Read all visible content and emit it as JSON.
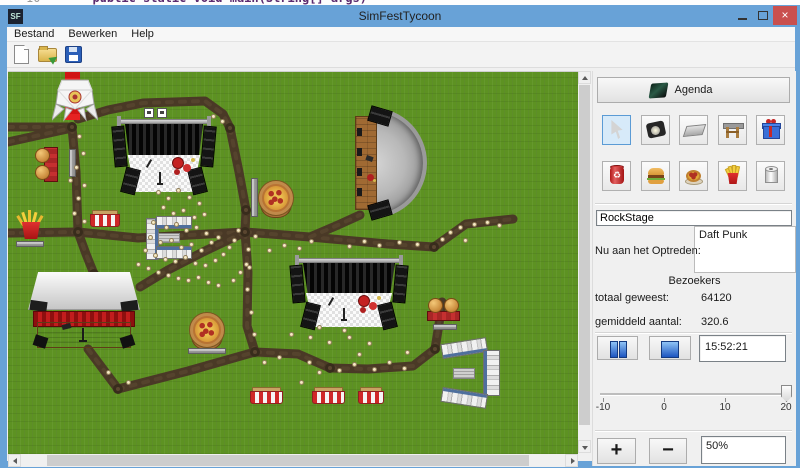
{
  "desktop": {
    "code_line_number": "10",
    "code_fragment": "public static void main(String[] args)"
  },
  "window": {
    "title": "SimFestTycoon",
    "icon_text": "SF",
    "menu": [
      "Bestand",
      "Bewerken",
      "Help"
    ],
    "toolbar_icons": [
      "new-file",
      "open-file",
      "save-file"
    ],
    "controls": {
      "minimize": "",
      "maximize": "",
      "close": "×"
    }
  },
  "panel": {
    "agenda_label": "Agenda",
    "tools": [
      "select-cursor",
      "stage-light",
      "path-tile",
      "stage-truss",
      "gift",
      "trash-can",
      "burger",
      "pizza",
      "fries",
      "toilet-roll"
    ],
    "selected_tool_index": 0,
    "stage_name_value": "RockStage",
    "now_performing_label": "Nu aan het Optreden:",
    "now_performing_value": "Daft Punk",
    "visitors_header": "Bezoekers",
    "total_label": "totaal geweest:",
    "total_value": "64120",
    "average_label": "gemiddeld aantal:",
    "average_value": "320.6",
    "time_value": "15:52:21",
    "slider": {
      "labels": [
        "-10",
        "0",
        "10",
        "20"
      ],
      "value": 20
    },
    "zoom_in_label": "+",
    "zoom_out_label": "−",
    "zoom_value": "50%"
  },
  "map": {
    "structures": [
      {
        "type": "red-carpet",
        "x": 57,
        "y": 0,
        "w": 15,
        "h": 48
      },
      {
        "type": "tent",
        "x": 44,
        "y": 6,
        "w": 46,
        "h": 44
      },
      {
        "type": "stage",
        "x": 105,
        "y": 44,
        "w": 102,
        "h": 78,
        "flags": true
      },
      {
        "type": "amphitheater",
        "x": 347,
        "y": 36,
        "w": 72,
        "h": 110
      },
      {
        "type": "burger-v",
        "x": 27,
        "y": 75,
        "w": 26,
        "h": 35
      },
      {
        "type": "bench-v",
        "x": 61,
        "y": 77,
        "w": 7,
        "h": 28
      },
      {
        "type": "bench-v",
        "x": 243,
        "y": 106,
        "w": 7,
        "h": 39
      },
      {
        "type": "pizza",
        "x": 250,
        "y": 108,
        "w": 36,
        "h": 40
      },
      {
        "type": "fries",
        "x": 5,
        "y": 140,
        "w": 36,
        "h": 28
      },
      {
        "type": "bench-h",
        "x": 8,
        "y": 169,
        "w": 28,
        "h": 6
      },
      {
        "type": "striped",
        "x": 82,
        "y": 138,
        "w": 30,
        "h": 17
      },
      {
        "type": "toilets-e",
        "x": 138,
        "y": 144,
        "w": 46,
        "h": 44
      },
      {
        "type": "barn",
        "x": 20,
        "y": 200,
        "w": 112,
        "h": 78
      },
      {
        "type": "pizza",
        "x": 181,
        "y": 240,
        "w": 38,
        "h": 40
      },
      {
        "type": "bench-h",
        "x": 180,
        "y": 276,
        "w": 38,
        "h": 6
      },
      {
        "type": "stage",
        "x": 283,
        "y": 183,
        "w": 116,
        "h": 74,
        "flags": false
      },
      {
        "type": "burger-h",
        "x": 419,
        "y": 226,
        "w": 33,
        "h": 24
      },
      {
        "type": "bench-h",
        "x": 425,
        "y": 252,
        "w": 24,
        "h": 6
      },
      {
        "type": "toilets-c",
        "x": 433,
        "y": 265,
        "w": 60,
        "h": 72
      },
      {
        "type": "striped",
        "x": 242,
        "y": 315,
        "w": 33,
        "h": 17
      },
      {
        "type": "striped",
        "x": 304,
        "y": 315,
        "w": 33,
        "h": 17
      },
      {
        "type": "striped",
        "x": 350,
        "y": 315,
        "w": 26,
        "h": 17
      }
    ],
    "paths": [
      [
        [
          0,
          55
        ],
        [
          64,
          55
        ]
      ],
      [
        [
          0,
          70
        ],
        [
          64,
          56
        ]
      ],
      [
        [
          64,
          55
        ],
        [
          68,
          100
        ],
        [
          70,
          160
        ]
      ],
      [
        [
          70,
          47
        ],
        [
          100,
          38
        ],
        [
          135,
          31
        ],
        [
          197,
          29
        ],
        [
          215,
          42
        ],
        [
          222,
          56
        ]
      ],
      [
        [
          222,
          56
        ],
        [
          231,
          100
        ],
        [
          238,
          138
        ],
        [
          237,
          160
        ]
      ],
      [
        [
          0,
          161
        ],
        [
          70,
          160
        ],
        [
          130,
          166
        ],
        [
          182,
          163
        ],
        [
          237,
          160
        ]
      ],
      [
        [
          237,
          160
        ],
        [
          302,
          165
        ],
        [
          380,
          172
        ],
        [
          426,
          175
        ]
      ],
      [
        [
          426,
          175
        ],
        [
          458,
          152
        ],
        [
          505,
          147
        ]
      ],
      [
        [
          302,
          165
        ],
        [
          330,
          153
        ],
        [
          352,
          143
        ]
      ],
      [
        [
          237,
          160
        ],
        [
          240,
          200
        ],
        [
          239,
          254
        ],
        [
          247,
          280
        ]
      ],
      [
        [
          237,
          160
        ],
        [
          195,
          180
        ],
        [
          160,
          198
        ],
        [
          132,
          215
        ]
      ],
      [
        [
          70,
          160
        ],
        [
          78,
          182
        ],
        [
          86,
          202
        ]
      ],
      [
        [
          80,
          277
        ],
        [
          110,
          317
        ]
      ],
      [
        [
          110,
          317
        ],
        [
          180,
          299
        ],
        [
          247,
          280
        ]
      ],
      [
        [
          247,
          280
        ],
        [
          290,
          282
        ],
        [
          322,
          296
        ],
        [
          360,
          297
        ],
        [
          405,
          294
        ],
        [
          427,
          277
        ]
      ],
      [
        [
          427,
          277
        ],
        [
          431,
          252
        ],
        [
          434,
          230
        ]
      ]
    ],
    "knots": [
      [
        64,
        55
      ],
      [
        70,
        160
      ],
      [
        237,
        160
      ],
      [
        426,
        175
      ],
      [
        110,
        317
      ],
      [
        427,
        277
      ],
      [
        322,
        296
      ],
      [
        86,
        202
      ],
      [
        247,
        280
      ],
      [
        222,
        56
      ],
      [
        238,
        138
      ]
    ],
    "visitors": [
      [
        150,
        120
      ],
      [
        160,
        126
      ],
      [
        170,
        118
      ],
      [
        181,
        125
      ],
      [
        191,
        131
      ],
      [
        155,
        135
      ],
      [
        165,
        141
      ],
      [
        175,
        138
      ],
      [
        186,
        145
      ],
      [
        196,
        142
      ],
      [
        145,
        150
      ],
      [
        158,
        155
      ],
      [
        168,
        152
      ],
      [
        178,
        158
      ],
      [
        188,
        155
      ],
      [
        198,
        161
      ],
      [
        142,
        165
      ],
      [
        152,
        170
      ],
      [
        163,
        168
      ],
      [
        173,
        175
      ],
      [
        183,
        172
      ],
      [
        193,
        178
      ],
      [
        203,
        170
      ],
      [
        210,
        165
      ],
      [
        137,
        178
      ],
      [
        147,
        183
      ],
      [
        157,
        187
      ],
      [
        167,
        189
      ],
      [
        177,
        185
      ],
      [
        187,
        191
      ],
      [
        197,
        193
      ],
      [
        207,
        188
      ],
      [
        215,
        182
      ],
      [
        221,
        175
      ],
      [
        226,
        168
      ],
      [
        130,
        192
      ],
      [
        140,
        196
      ],
      [
        150,
        200
      ],
      [
        160,
        203
      ],
      [
        170,
        206
      ],
      [
        180,
        208
      ],
      [
        190,
        205
      ],
      [
        200,
        210
      ],
      [
        210,
        213
      ],
      [
        225,
        208
      ],
      [
        232,
        200
      ],
      [
        238,
        192
      ],
      [
        71,
        64
      ],
      [
        75,
        81
      ],
      [
        68,
        95
      ],
      [
        62,
        108
      ],
      [
        76,
        113
      ],
      [
        70,
        126
      ],
      [
        66,
        141
      ],
      [
        76,
        149
      ],
      [
        205,
        44
      ],
      [
        214,
        49
      ],
      [
        230,
        158
      ],
      [
        247,
        164
      ],
      [
        261,
        178
      ],
      [
        276,
        173
      ],
      [
        291,
        176
      ],
      [
        303,
        169
      ],
      [
        341,
        174
      ],
      [
        356,
        169
      ],
      [
        371,
        173
      ],
      [
        391,
        170
      ],
      [
        409,
        172
      ],
      [
        434,
        167
      ],
      [
        442,
        160
      ],
      [
        452,
        155
      ],
      [
        466,
        152
      ],
      [
        479,
        150
      ],
      [
        491,
        153
      ],
      [
        457,
        168
      ],
      [
        240,
        177
      ],
      [
        241,
        195
      ],
      [
        239,
        217
      ],
      [
        243,
        240
      ],
      [
        246,
        262
      ],
      [
        256,
        290
      ],
      [
        271,
        285
      ],
      [
        301,
        290
      ],
      [
        311,
        300
      ],
      [
        331,
        298
      ],
      [
        346,
        292
      ],
      [
        366,
        297
      ],
      [
        381,
        290
      ],
      [
        396,
        296
      ],
      [
        302,
        265
      ],
      [
        321,
        270
      ],
      [
        341,
        265
      ],
      [
        361,
        271
      ],
      [
        293,
        310
      ],
      [
        283,
        262
      ],
      [
        351,
        282
      ],
      [
        399,
        280
      ],
      [
        311,
        255
      ],
      [
        336,
        258
      ],
      [
        120,
        310
      ],
      [
        100,
        300
      ]
    ]
  }
}
